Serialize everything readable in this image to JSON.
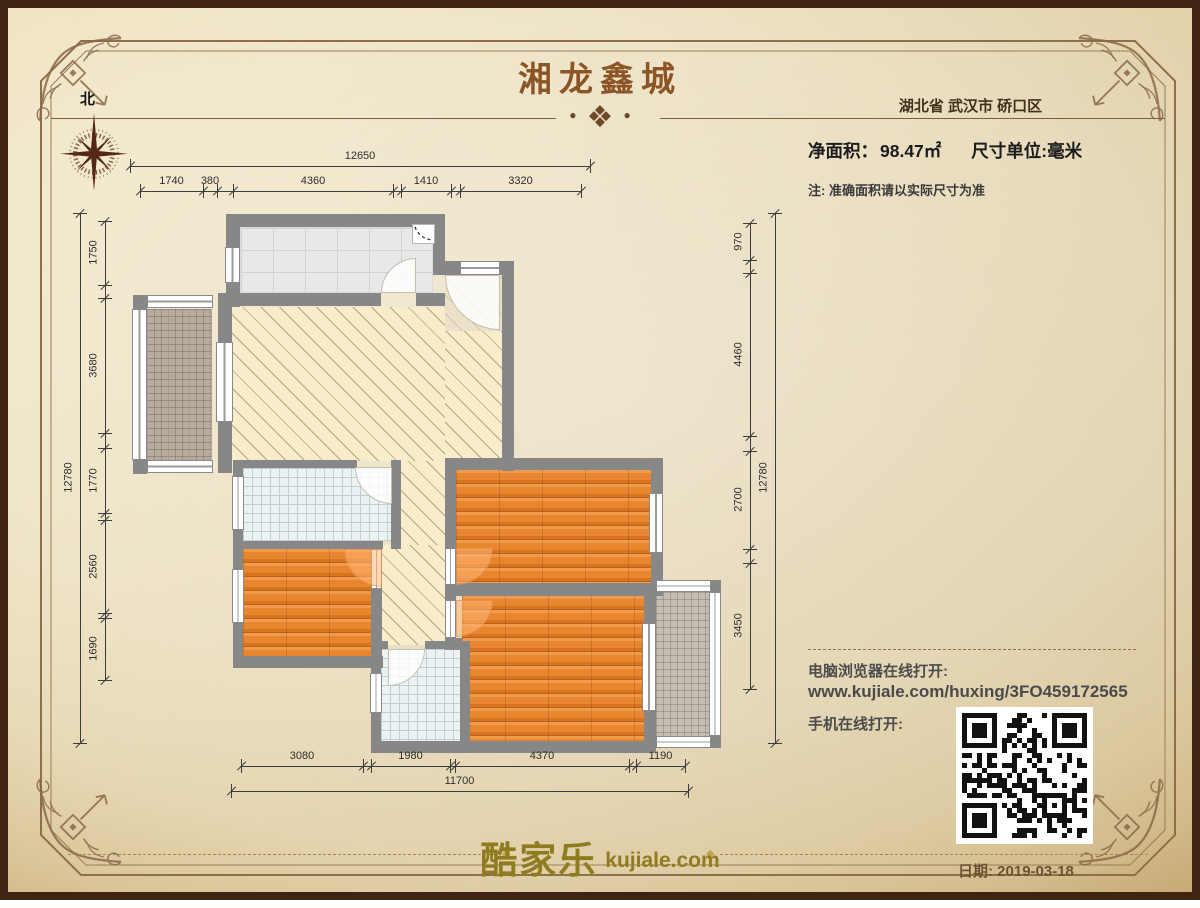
{
  "page": {
    "colors": {
      "border": "#3f2412",
      "frame": "#8f6f49",
      "wall": "#878787",
      "wood_floor": "#e9883a",
      "title_brown": "#8c5526",
      "logo_gold": "#8f7c20"
    }
  },
  "header": {
    "title": "湘龙鑫城",
    "location": "湖北省 武汉市 硚口区",
    "area_label": "净面积：",
    "area_value": "98.47㎡",
    "unit_label": "尺寸单位:毫米",
    "note": "注: 准确面积请以实际尺寸为准"
  },
  "compass": {
    "north_label": "北",
    "icon": "compass-rose-icon"
  },
  "plan": {
    "unit": "mm",
    "dimensions": {
      "top": {
        "total": "12650",
        "segments": [
          "1740",
          "380",
          "4360",
          "1410",
          "3320"
        ]
      },
      "bottom": {
        "total": "11700",
        "segments": [
          "3080",
          "1980",
          "4370",
          "1190"
        ]
      },
      "left": {
        "total": "12780",
        "segments": [
          "1750",
          "3680",
          "1770",
          "2560",
          "1690"
        ]
      },
      "right": {
        "total": "12780",
        "segments": [
          "970",
          "4460",
          "2700",
          "3450"
        ]
      }
    }
  },
  "links": {
    "pc_label": "电脑浏览器在线打开:",
    "url": "www.kujiale.com/huxing/3FO459172565",
    "mobile_label": "手机在线打开:",
    "qr_icon": "qr-code"
  },
  "footer": {
    "logo_cn": "酷家乐",
    "logo_en": "kujiale.com",
    "date_label": "日期:",
    "date_value": "2019-03-18"
  }
}
